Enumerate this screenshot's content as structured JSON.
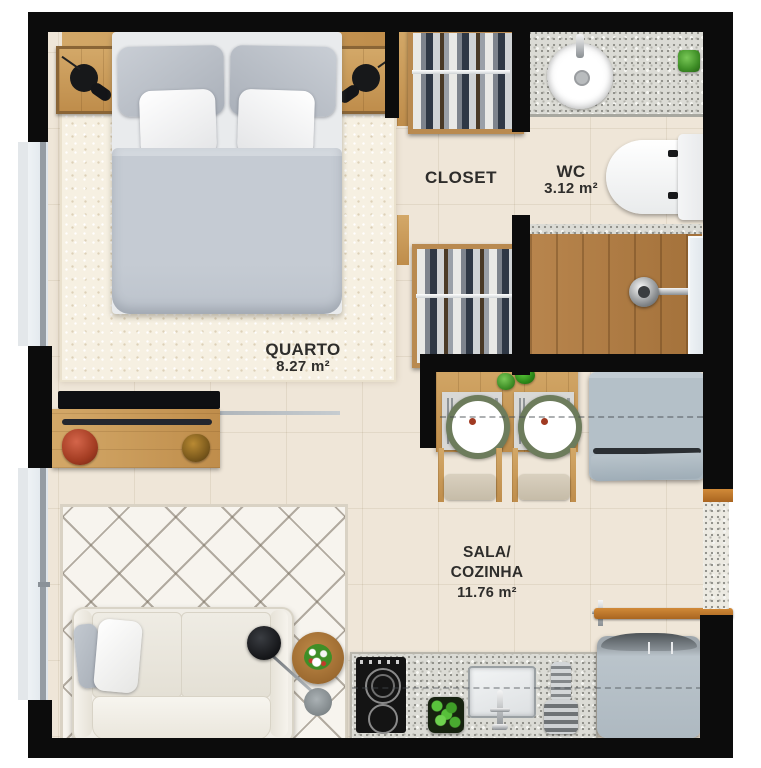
{
  "plan_title": "studio-apartment-floor-plan",
  "rooms": {
    "quarto": {
      "label": "QUARTO",
      "area": "8.27 m²"
    },
    "closet": {
      "label": "CLOSET"
    },
    "wc": {
      "label": "WC",
      "area": "3.12 m²"
    },
    "sala": {
      "label_line1": "SALA/",
      "label_line2": "COZINHA",
      "area": "11.76 m²"
    }
  },
  "colors": {
    "wall": "#0c0c0c",
    "floor": "#efe6d8",
    "rug": "#f6f0e2",
    "wood_light": "#d3a868",
    "wood_dark": "#bf8d4b",
    "shower_wood": "#b07c44",
    "appliance_gray": "#b3bfc7",
    "granite_gray": "#dbdbd5",
    "accent_orange": "#c47b2b",
    "plate_rim_green": "#6d7c5c",
    "duvet_gray": "#c5cbd3",
    "tv_black": "#0e0f12"
  }
}
